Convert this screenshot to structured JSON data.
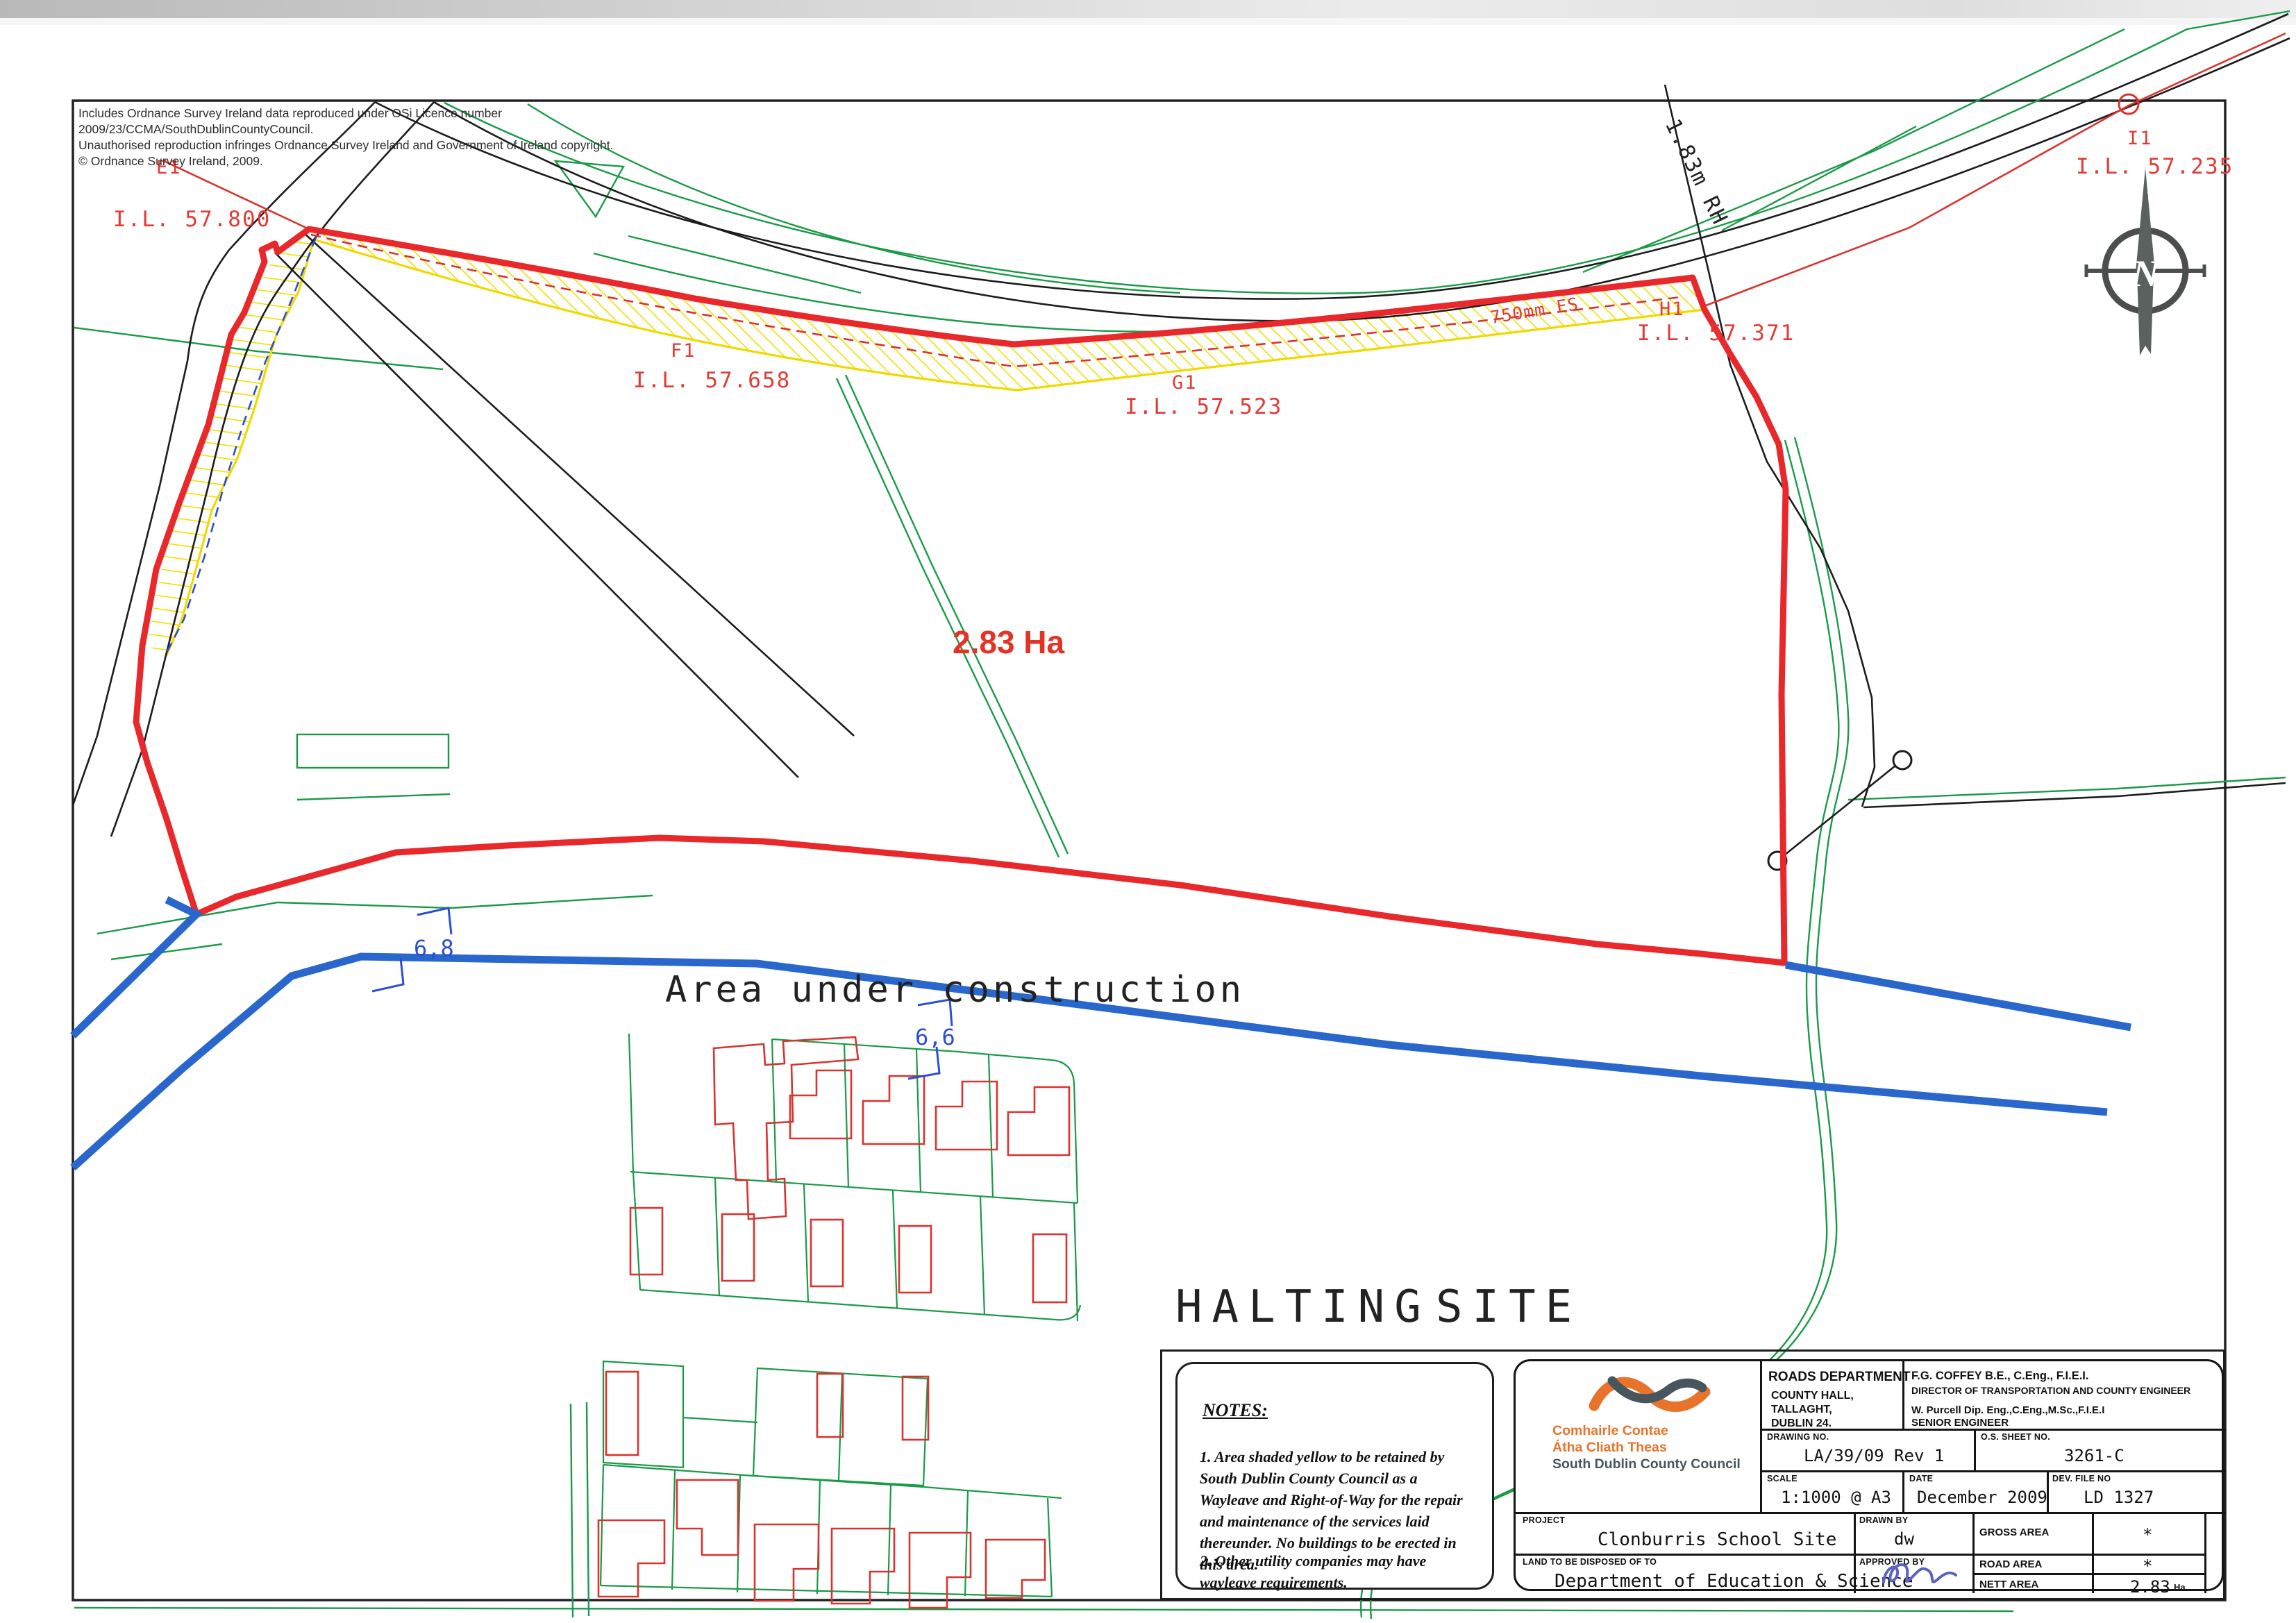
{
  "colors": {
    "boundary_red": "#e8282b",
    "thin_red": "#d9332f",
    "label_red": "#e03b35",
    "yellow": "#efd900",
    "green": "#1a9a47",
    "blue_thick": "#2a67cc",
    "blue_dim": "#2b4fd0",
    "black": "#1c1c1c",
    "orange": "#e8742c",
    "slate": "#46565c",
    "signature_blue": "#5b63c0"
  },
  "copyright": "Includes Ordnance Survey Ireland data reproduced under OSi Licence number 2009/23/CCMA/SouthDublinCountyCouncil.\nUnauthorised reproduction infringes Ordnance Survey Ireland and Government of Ireland copyright.\n© Ordnance Survey Ireland, 2009.",
  "map": {
    "site_area_label": "2.83 Ha",
    "construction_label": "Area under construction",
    "halting_word1": "HALTING",
    "halting_word2": "SITE",
    "dim1": "6,8",
    "dim2": "6,6",
    "compass_letter": "N",
    "labels": {
      "e1": "E1",
      "il57800": "I.L. 57.800",
      "f1": "F1",
      "il57658": "I.L. 57.658",
      "g1": "G1",
      "il57523": "I.L. 57.523",
      "fs750": "750mm FS",
      "h1": "H1",
      "il57371": "I.L. 57.371",
      "i1": "I1",
      "il57235": "I.L. 57.235",
      "rh183": "1.83m RH"
    }
  },
  "notes": {
    "title": "NOTES:",
    "note1": "1. Area shaded yellow to be retained by South Dublin County Council as a Wayleave and Right-of-Way for the repair and maintenance of the services laid thereunder. No buildings to be erected in this area.",
    "note2": "2. Other utility companies may have wayleave requirements."
  },
  "title_block": {
    "logo": {
      "line1": "Comhairle Contae",
      "line2": "Átha Cliath Theas",
      "line3": "South Dublin County Council"
    },
    "department": "ROADS DEPARTMENT",
    "address": "COUNTY HALL,\nTALLAGHT,\nDUBLIN 24.",
    "engineer1": "F.G. COFFEY  B.E., C.Eng., F.I.E.I.",
    "engineer1_title": "DIRECTOR OF TRANSPORTATION AND COUNTY ENGINEER",
    "engineer2": "W. Purcell Dip. Eng.,C.Eng.,M.Sc.,F.I.E.I",
    "engineer2_title": "SENIOR ENGINEER",
    "labels": {
      "drawing_no": "DRAWING NO.",
      "os_sheet": "O.S. SHEET NO.",
      "scale": "SCALE",
      "date": "DATE",
      "dev_file": "DEV. FILE NO",
      "project": "PROJECT",
      "drawn_by": "DRAWN BY",
      "approved_by": "APPROVED BY",
      "land": "LAND TO BE DISPOSED OF TO",
      "gross": "GROSS AREA",
      "road": "ROAD AREA",
      "nett": "NETT AREA"
    },
    "values": {
      "drawing_no": "LA/39/09  Rev 1",
      "os_sheet": "3261-C",
      "scale": "1:1000  @  A3",
      "date": "December 2009",
      "dev_file": "LD 1327",
      "project": "Clonburris  School  Site",
      "drawn_by": "dw",
      "land": "Department  of  Education  &  Science",
      "gross": "*",
      "road": "*",
      "nett": "2.83",
      "nett_unit": "Ha"
    }
  }
}
